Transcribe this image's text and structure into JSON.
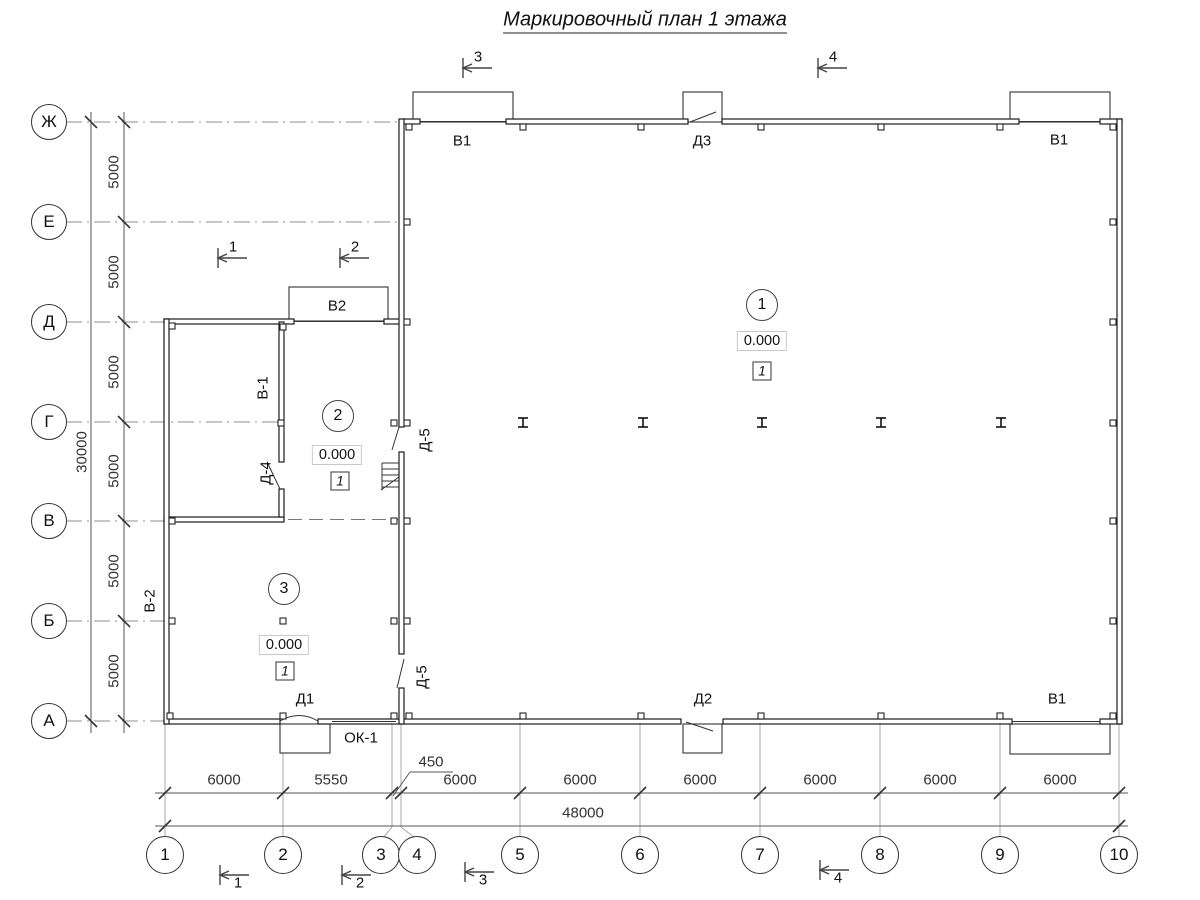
{
  "title": "Маркировочный план 1 этажа",
  "axes": {
    "rows": [
      "Ж",
      "Е",
      "Д",
      "Г",
      "В",
      "Б",
      "А"
    ],
    "cols": [
      "1",
      "2",
      "3",
      "4",
      "5",
      "6",
      "7",
      "8",
      "9",
      "10"
    ]
  },
  "dimensions": {
    "left_segments": [
      "5000",
      "5000",
      "5000",
      "5000",
      "5000",
      "5000"
    ],
    "left_total": "30000",
    "bottom_segments": [
      "6000",
      "5550",
      "6000",
      "6000",
      "6000",
      "6000",
      "6000",
      "6000"
    ],
    "offset_dim": "450",
    "bottom_total": "48000"
  },
  "openings": {
    "v1_top_left": "В1",
    "d3_top": "Д3",
    "v1_top_right": "В1",
    "v2_canopy": "В2",
    "v1_wall": "В-1",
    "d4_door": "Д-4",
    "d5_upper": "Д-5",
    "d5_lower": "Д-5",
    "v2_wall": "В-2",
    "d1_door": "Д1",
    "ok1_window": "ОК-1",
    "d2_bottom": "Д2",
    "v1_bottom_right": "В1"
  },
  "rooms": [
    {
      "number": "1",
      "elevation": "0.000",
      "floor_type": "1"
    },
    {
      "number": "2",
      "elevation": "0.000",
      "floor_type": "1"
    },
    {
      "number": "3",
      "elevation": "0.000",
      "floor_type": "1"
    }
  ],
  "sections": {
    "top": [
      "3",
      "4"
    ],
    "middle": [
      "1",
      "2"
    ],
    "bottom": [
      "1",
      "2",
      "3",
      "4"
    ]
  }
}
